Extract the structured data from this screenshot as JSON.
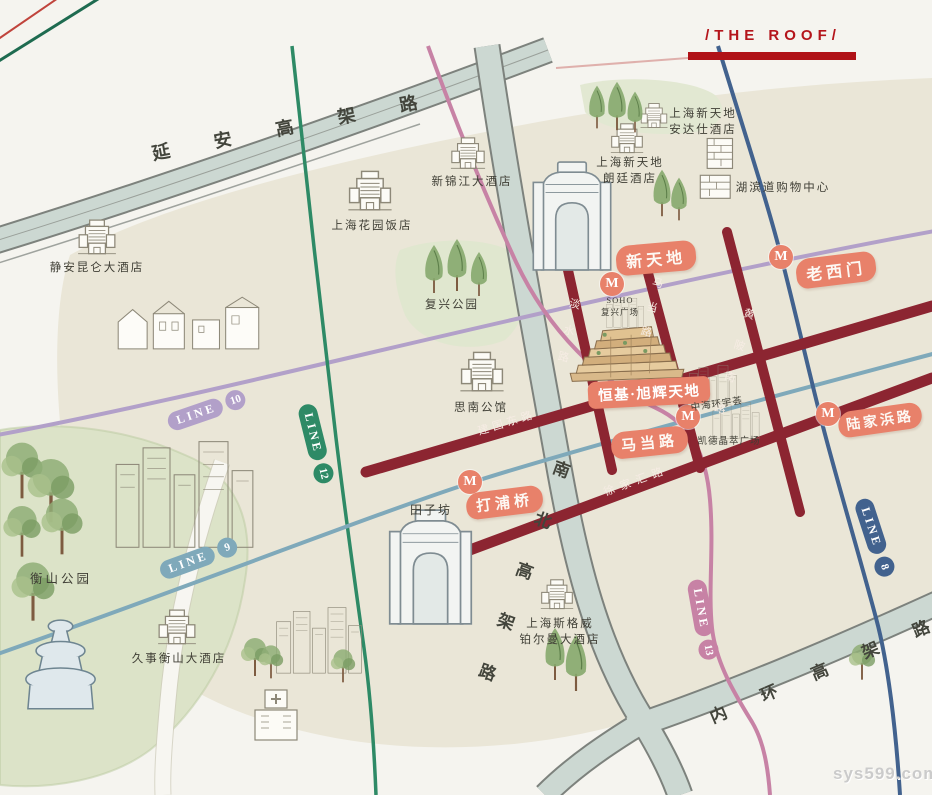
{
  "header": {
    "title": "/THE ROOF/"
  },
  "watermark": "sys599.com",
  "metro": {
    "m": "M"
  },
  "stations": [
    {
      "id": "xintiandi",
      "name": "新天地"
    },
    {
      "id": "laoximen",
      "name": "老西门"
    },
    {
      "id": "madanglu",
      "name": "马当路"
    },
    {
      "id": "dapuqiao",
      "name": "打浦桥"
    },
    {
      "id": "lujiabanglu",
      "name": "陆家浜路"
    }
  ],
  "lines": [
    {
      "id": "line-10",
      "label": "LINE",
      "number": "10",
      "color": "#b2a0c9"
    },
    {
      "id": "line-12",
      "label": "LINE",
      "number": "12",
      "color": "#2e8a66"
    },
    {
      "id": "line-9",
      "label": "LINE",
      "number": "9",
      "color": "#7fa9ba"
    },
    {
      "id": "line-13",
      "label": "LINE",
      "number": "13",
      "color": "#c782a5"
    },
    {
      "id": "line-8",
      "label": "LINE",
      "number": "8",
      "color": "#42628e"
    }
  ],
  "highways": [
    {
      "id": "yanan",
      "name": "延安高架路"
    },
    {
      "id": "nanbei",
      "name": "南北高架路"
    },
    {
      "id": "neihuan",
      "name": "内环高架路"
    }
  ],
  "streets": [
    {
      "id": "danshui",
      "name": "淡水路"
    },
    {
      "id": "madang",
      "name": "马当路"
    },
    {
      "id": "huangpinan",
      "name": "黄陂南路"
    },
    {
      "id": "jianguodong",
      "name": "建国东路"
    },
    {
      "id": "xujiahui",
      "name": "徐家汇路"
    }
  ],
  "project": {
    "name": "恒基·旭辉天地"
  },
  "landmarks": [
    {
      "id": "jingan-kunlun-hotel",
      "name": "静安昆仑大酒店"
    },
    {
      "id": "garden-hotel",
      "name": "上海花园饭店"
    },
    {
      "id": "new-jinjiang-hotel",
      "name": "新锦江大酒店"
    },
    {
      "id": "langham-hotel",
      "line1": "上海新天地",
      "line2": "朗廷酒店"
    },
    {
      "id": "andaz-hotel",
      "line1": "上海新天地",
      "line2": "安达仕酒店"
    },
    {
      "id": "hubindao-mall",
      "name": "湖滨道购物中心"
    },
    {
      "id": "fuxing-park",
      "name": "复兴公园"
    },
    {
      "id": "sinan-mansions",
      "name": "思南公馆"
    },
    {
      "id": "soho-fuxing-plaza",
      "line1": "SOHO",
      "line2": "复兴广场"
    },
    {
      "id": "zhonghai-huanyuhui",
      "name": "中海环宇荟"
    },
    {
      "id": "capitamall-jingcui",
      "name": "凯德晶萃广场"
    },
    {
      "id": "tianzifang",
      "name": "田子坊"
    },
    {
      "id": "hengshan-park",
      "name": "衡山公园"
    },
    {
      "id": "jiushi-hengshan-hotel",
      "name": "久事衡山大酒店"
    },
    {
      "id": "pullman-hotel",
      "line1": "上海斯格威",
      "line2": "铂尔曼大酒店"
    }
  ]
}
